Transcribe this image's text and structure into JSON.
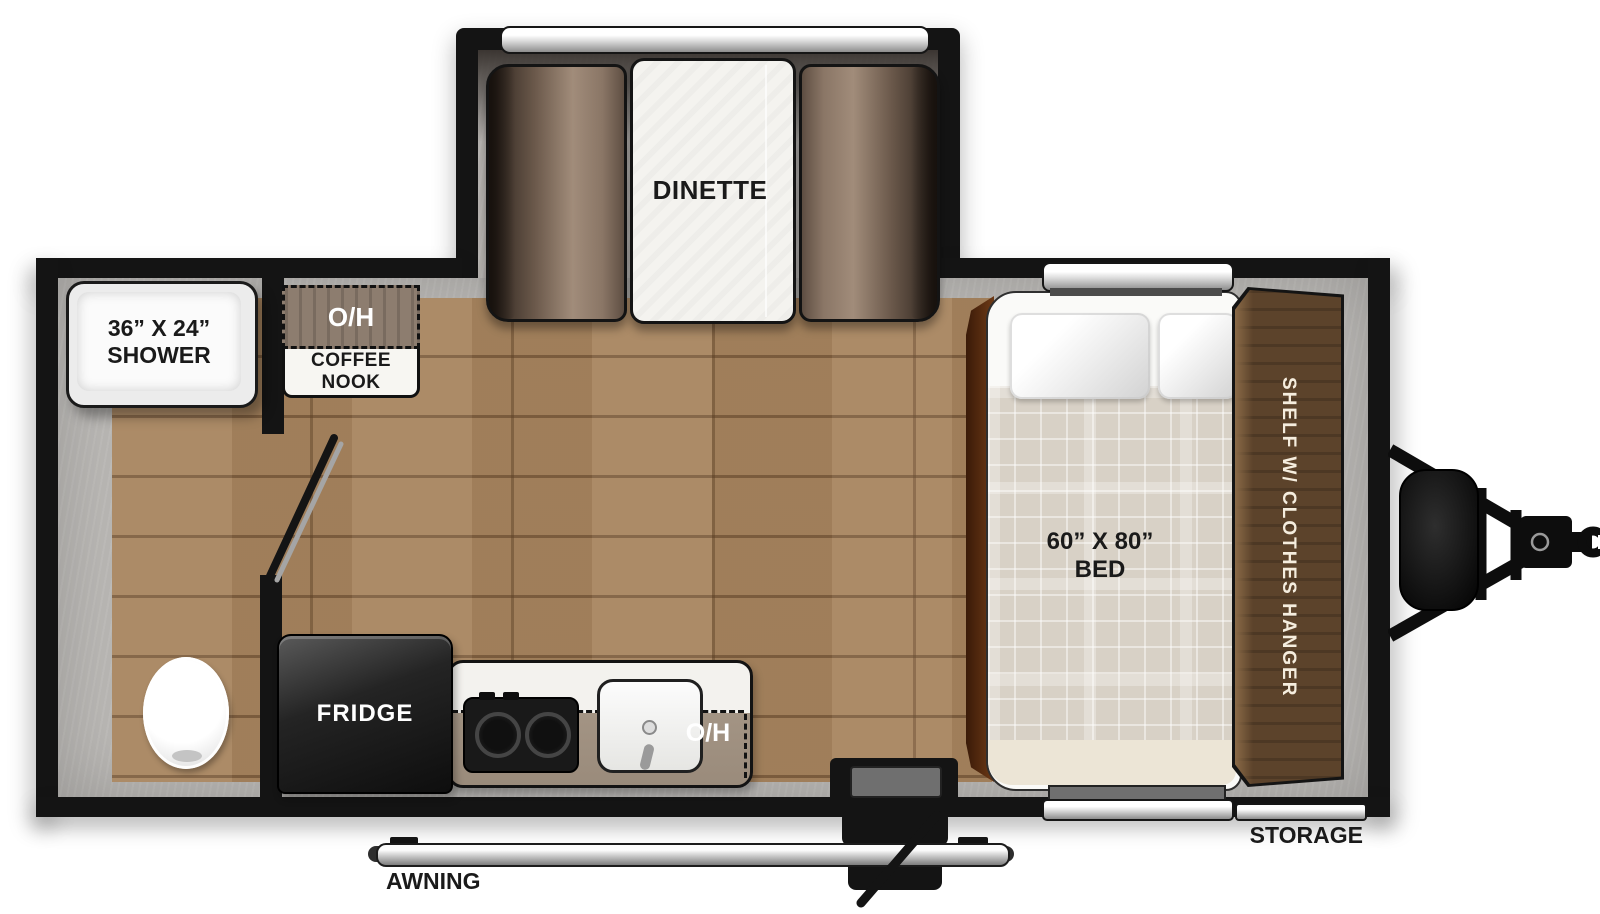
{
  "slideout": {
    "dinette_label": "DINETTE"
  },
  "bathroom": {
    "shower_size": "36” X 24”",
    "shower_name": "SHOWER"
  },
  "coffee_nook": {
    "overhead_label": "O/H",
    "name_label": "COFFEE NOOK"
  },
  "kitchen": {
    "fridge_label": "FRIDGE",
    "overhead_label": "O/H"
  },
  "bedroom": {
    "bed_size": "60” X 80”",
    "bed_name": "BED",
    "shelf_label": "SHELF W/ CLOTHES HANGER"
  },
  "exterior": {
    "storage_label": "STORAGE",
    "awning_label": "AWNING"
  },
  "colors": {
    "wall": "#141414",
    "floor_wood": "#a8855f",
    "interior_gray": "#b9b7b4",
    "seat_brown": "#8a7666",
    "table_white": "#f4f3ef",
    "shelf_brown": "#5c432b",
    "bed_platform_brown": "#5e2f12",
    "bed_plaid": "#d8d1c6",
    "counter_overhead_taupe": "#9e9082",
    "nook_overhead_brown": "#8d7d6f",
    "window_silver": "#cfcfcf",
    "appliance_black": "#151515"
  }
}
